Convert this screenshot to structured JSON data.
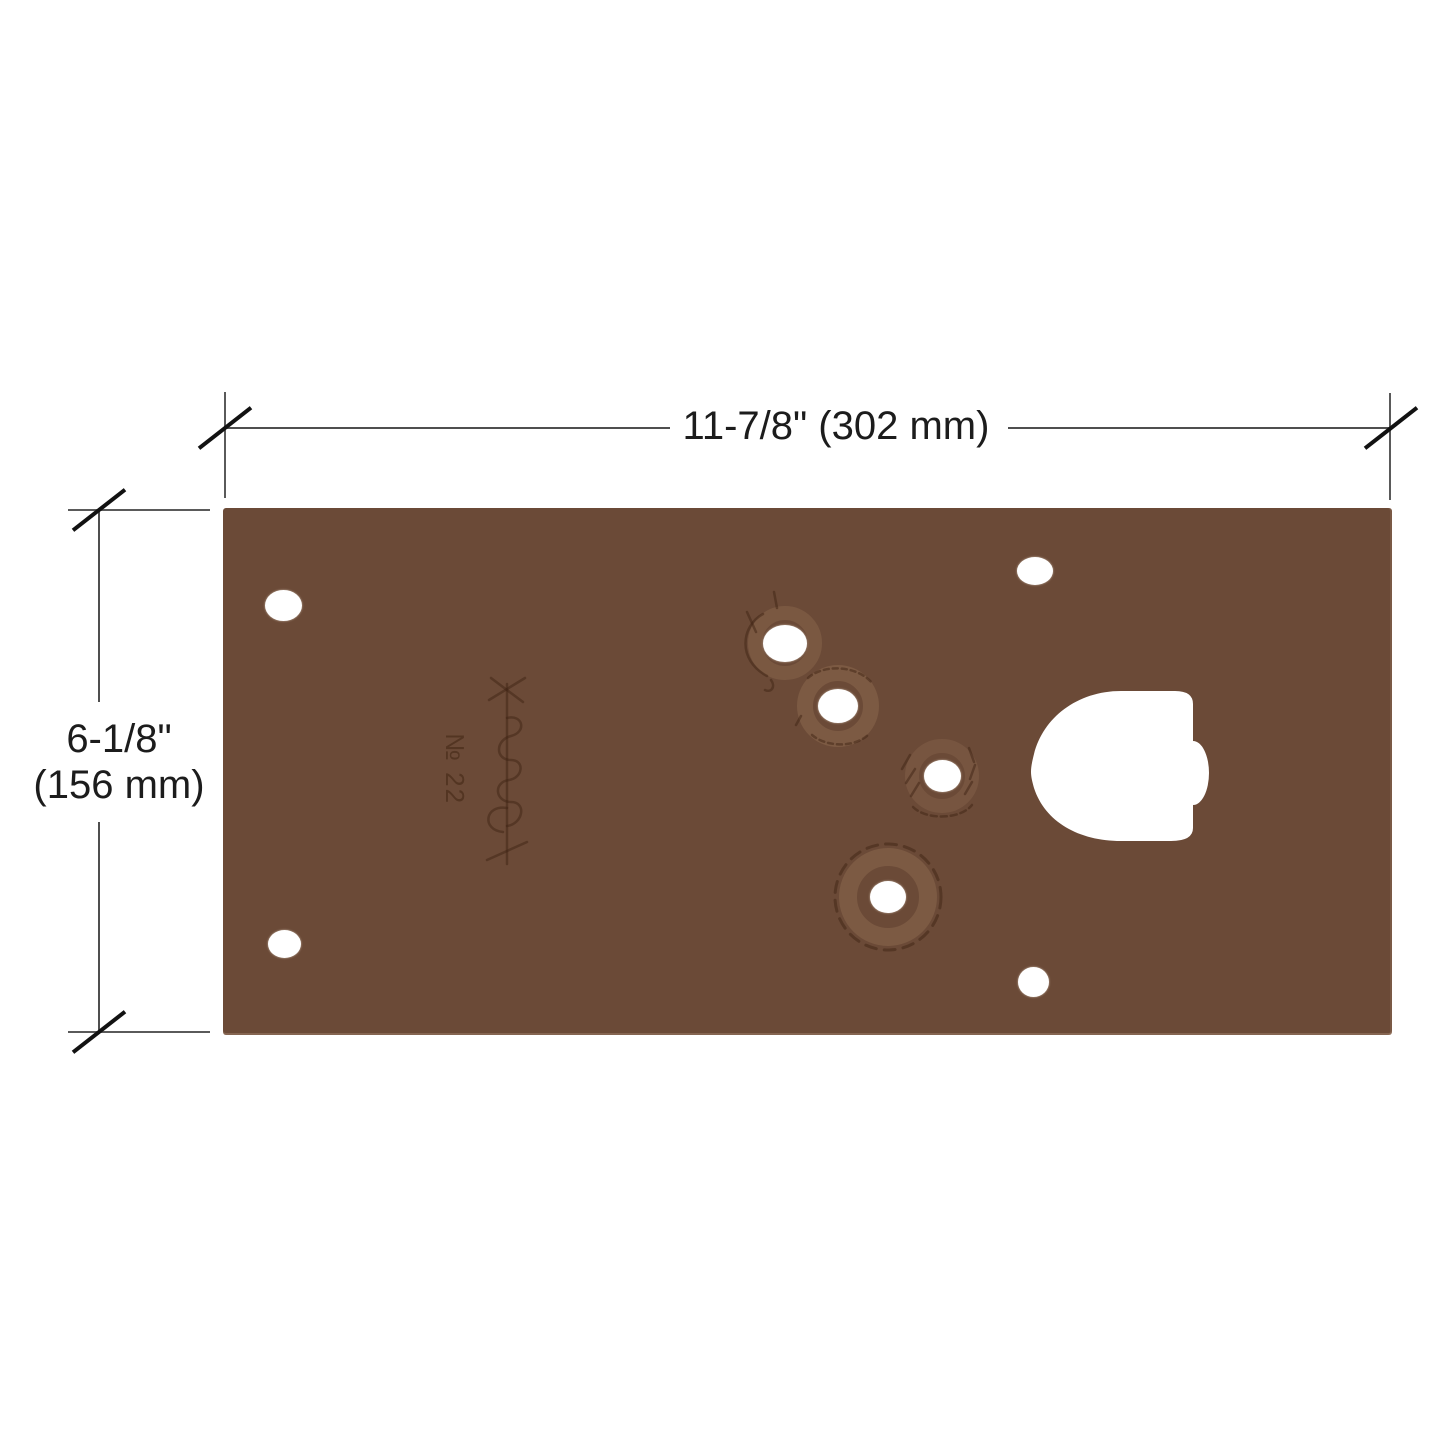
{
  "page": {
    "background": "#ffffff",
    "description": "technical dimension diagram of a dark bronze floor closer cover plate"
  },
  "dimension_annotations": {
    "width": {
      "label": "11-7/8\" (302 mm)"
    },
    "height": {
      "label_inches": "6-1/8\"",
      "label_mm": "(156 mm)"
    }
  },
  "plate": {
    "finish_color": "#6b4a37",
    "engraved_model_number": "№ 22",
    "holes": [
      {
        "id": "left-top",
        "cx": 60,
        "cy": 97,
        "rx": 18.5,
        "ry": 15.5
      },
      {
        "id": "left-bottom",
        "cx": 61,
        "cy": 436,
        "rx": 16.5,
        "ry": 14
      },
      {
        "id": "right-top",
        "cx": 812,
        "cy": 63,
        "rx": 18,
        "ry": 14
      },
      {
        "id": "right-bottom",
        "cx": 810,
        "cy": 474,
        "rx": 15.5,
        "ry": 15
      },
      {
        "id": "diagonal-1",
        "cx": 562,
        "cy": 135,
        "rx": 22,
        "ry": 18.5
      },
      {
        "id": "diagonal-2",
        "cx": 615,
        "cy": 198,
        "rx": 20,
        "ry": 17
      },
      {
        "id": "diagonal-3",
        "cx": 719,
        "cy": 268,
        "rx": 18.5,
        "ry": 16
      },
      {
        "id": "diagonal-4",
        "cx": 665,
        "cy": 389,
        "rx": 18,
        "ry": 16
      }
    ],
    "cutout": {
      "shape": "d-shaped spindle cutout, flat right edge with center bulge"
    }
  },
  "style": {
    "line_color": "#4f4f4f",
    "tick_color": "#121212",
    "text_color": "#1c1c1c",
    "hole_color": "#ffffff",
    "engraving_dark": "#3f2413",
    "engraving_halo": "#b08d68"
  }
}
